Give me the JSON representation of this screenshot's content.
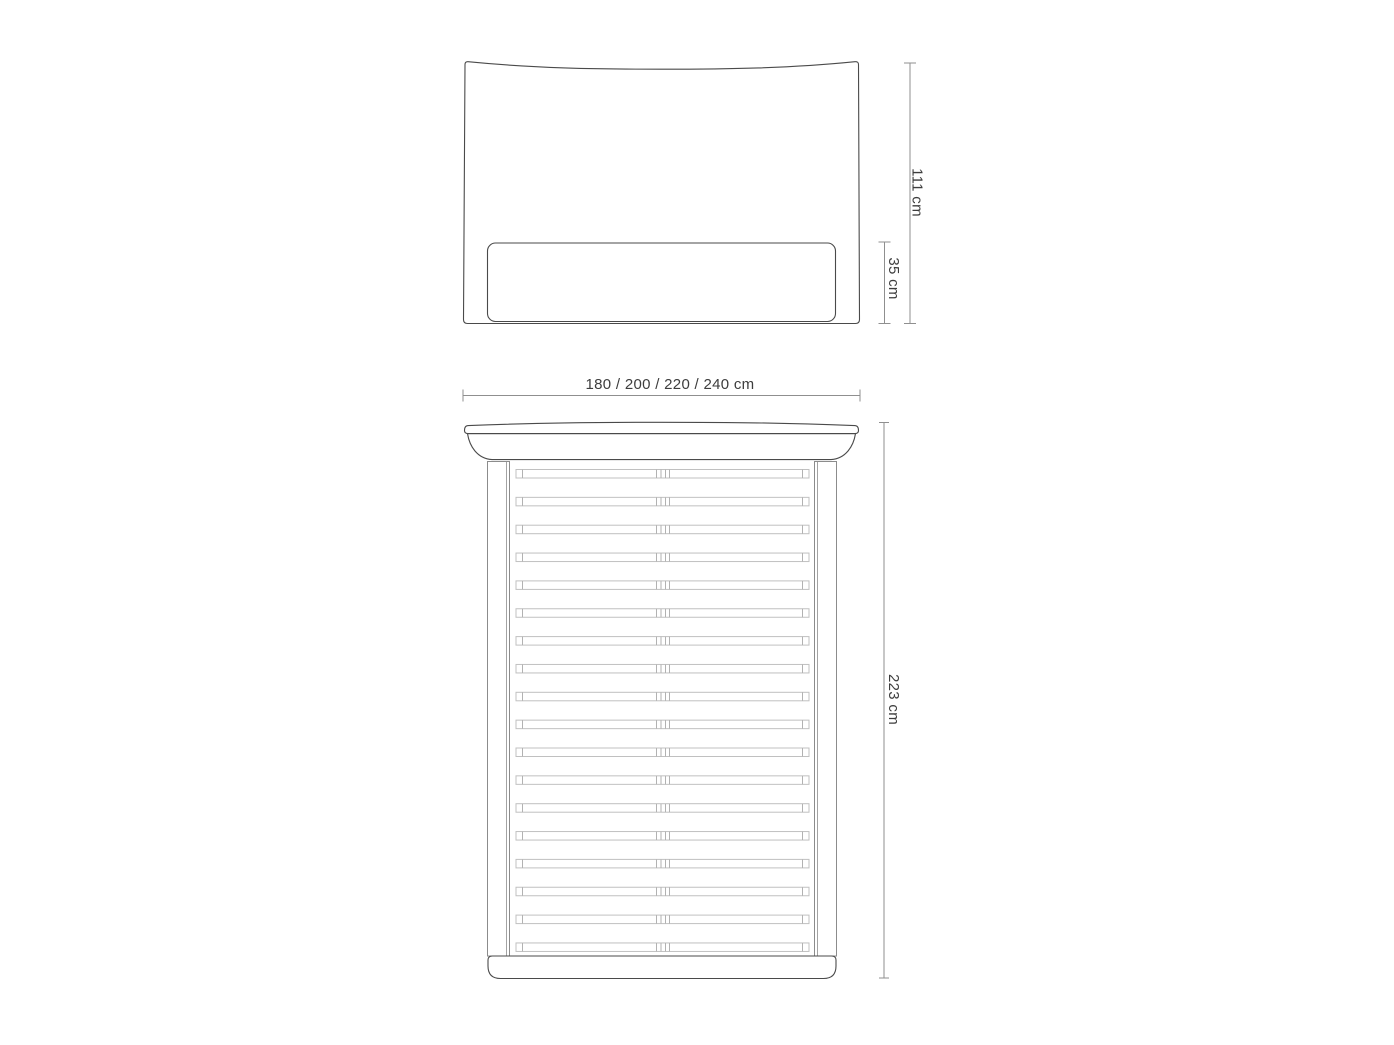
{
  "diagram": {
    "title": "bed-dimensions-technical-drawing",
    "labels": {
      "headboard_height": "111 cm",
      "panel_height": "35 cm",
      "width_options": "180 / 200 / 220 / 240 cm",
      "length": "223 cm"
    },
    "top_view": {
      "slat_count": 18,
      "slat_columns": 2
    },
    "colors": {
      "background": "#ffffff",
      "outline": "#4a4a4a",
      "rail": "#8c8c8c",
      "slat": "#c0c0c0",
      "dimension": "#8f8f8f",
      "text": "#3d3d3d"
    }
  }
}
